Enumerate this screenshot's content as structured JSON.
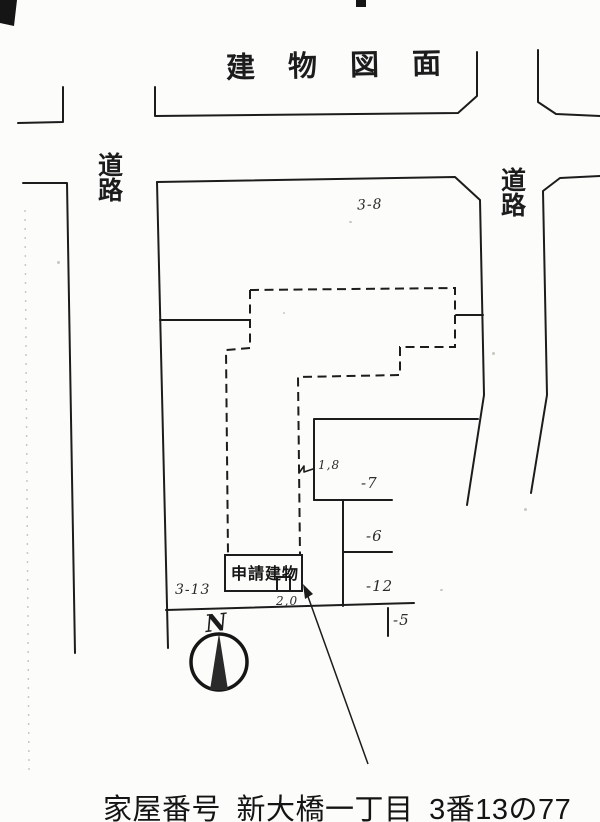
{
  "document": {
    "title": "建物図面",
    "caption": "家屋番号 新大橋一丁目 3番13の77"
  },
  "plan": {
    "road_left": "道路",
    "road_right": "道路",
    "parcel_north": "3-8",
    "parcel_site": "3-13",
    "parcel_east_upper": "-7",
    "parcel_east_middle": "-6",
    "parcel_east_lower": "-12",
    "parcel_south": "-5",
    "dim_step": "1,8",
    "dim_entrance": "2,0",
    "applied_building": "申請建物",
    "compass_north": "N"
  },
  "colors": {
    "ink": "#1c1c1c",
    "paper": "#fcfcfa"
  }
}
